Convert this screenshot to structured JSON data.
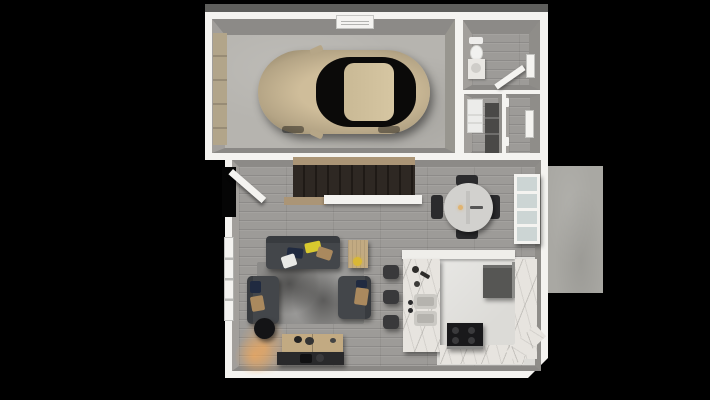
{
  "scene": {
    "description": "Top-down 3D architectural rendering of a house ground floor with attached garage and rear deck",
    "background": "#000000"
  },
  "palette": {
    "wall": "#f4f3f0",
    "wall-face": "#8c8a87",
    "wall-face-light": "#a29f9b",
    "wood": "#9d9b98",
    "concrete": "#b6b4af",
    "tile": "#dcdbd7",
    "marble": "#e7e4df",
    "deck": "#a9a8a3",
    "rug": "#8b8a88",
    "sofa": "#43464a",
    "pillow-yellow": "#d8c92f",
    "pillow-tan": "#aa895e",
    "pillow-navy": "#202a40",
    "pillow-white": "#e9e9e6",
    "wood-furniture": "#c2aa82",
    "dark-furniture": "#29292b",
    "car-body": "#c2b190",
    "car-glass": "#0b0a09",
    "stair-tread": "#2e2823",
    "stair-wood": "#ab9576",
    "cabinet-dark": "#565654",
    "stool": "#39393b",
    "glass": "#ccd5d4",
    "glow": "#ffaa50"
  },
  "rooms": {
    "garage": {
      "label": "Garage"
    },
    "bathroom": {
      "label": "Bathroom"
    },
    "laundry": {
      "label": "Laundry / pantry closet"
    },
    "mudroom": {
      "label": "Mudroom"
    },
    "living": {
      "label": "Living room"
    },
    "dining": {
      "label": "Dining area"
    },
    "kitchen": {
      "label": "Kitchen"
    },
    "stairs": {
      "label": "Staircase"
    },
    "deck": {
      "label": "Deck"
    }
  },
  "objects": {
    "car": {
      "label": "Car"
    },
    "garage-door": {
      "label": "Garage door"
    },
    "vent": {
      "label": "Garage wall vent"
    },
    "toilet": {
      "label": "Toilet"
    },
    "vanity": {
      "label": "Bathroom vanity"
    },
    "washer": {
      "label": "Washer / dryer"
    },
    "shelves": {
      "label": "Storage shelves"
    },
    "hooks": {
      "label": "Coat hooks"
    },
    "front-door": {
      "label": "Front door (open)"
    },
    "window": {
      "label": "Window"
    },
    "sofa": {
      "label": "Sofa"
    },
    "armchair": {
      "label": "Armchair"
    },
    "rug": {
      "label": "Area rug"
    },
    "side-table": {
      "label": "Side table"
    },
    "floor-lamp": {
      "label": "Floor lamp"
    },
    "media-console": {
      "label": "Media console"
    },
    "tv-bench": {
      "label": "TV bench"
    },
    "dining-table": {
      "label": "Round dining table"
    },
    "dining-chair": {
      "label": "Dining chair"
    },
    "sliding-door": {
      "label": "Sliding glass door"
    },
    "island": {
      "label": "Kitchen island with sinks"
    },
    "bar-stool": {
      "label": "Bar stool"
    },
    "cabinets": {
      "label": "Kitchen cabinets"
    },
    "counter": {
      "label": "Kitchen counter"
    },
    "stove": {
      "label": "Range / stove"
    }
  }
}
